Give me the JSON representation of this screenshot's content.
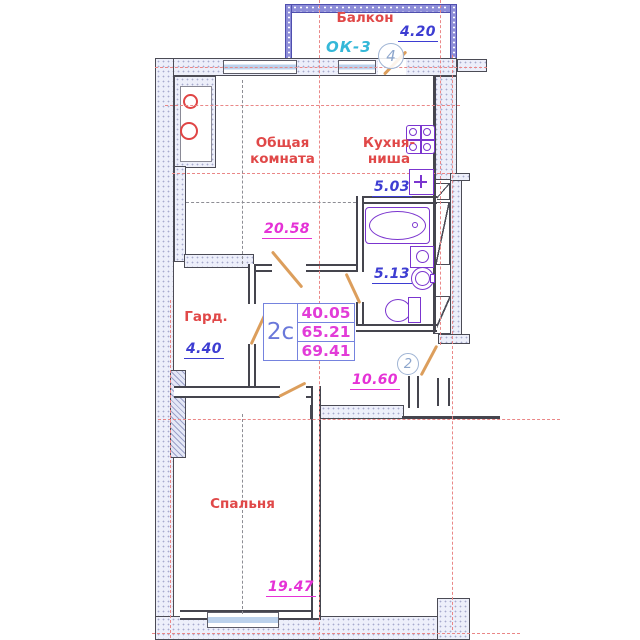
{
  "plan_type": "apartment-floor-plan",
  "rooms": {
    "balcony": {
      "name": "Балкон",
      "window_code": "ОК-3",
      "area": "4.20"
    },
    "common": {
      "name_line1": "Общая",
      "name_line2": "комната",
      "area": "20.58"
    },
    "kitchen": {
      "name_line1": "Кухня-",
      "name_line2": "ниша",
      "area": "5.03"
    },
    "bathroom": {
      "area": "5.13"
    },
    "wardrobe": {
      "name": "Гард.",
      "area": "4.40"
    },
    "hall": {
      "area": "10.60"
    },
    "bedroom": {
      "name": "Спальня",
      "area": "19.47"
    }
  },
  "summary": {
    "code": "2с",
    "rows": [
      "40.05",
      "65.21",
      "69.41"
    ]
  },
  "markers": {
    "balcony_axis": "4",
    "entrance": "2"
  },
  "colors": {
    "room_label_red": "#e04848",
    "area_blue": "#3d3dd2",
    "area_magenta": "#e532d6",
    "window_code_cyan": "#35b8d8",
    "summary_border_blue": "#7583de",
    "door_orange": "#dc9e5c",
    "fixture_purple": "#7b35cf",
    "axis_red": "#ea8787",
    "wall_dark": "#4b4b55",
    "wall_hatch_fill": "#edeffa",
    "balcony_glazing_blue": "#8d8dd8",
    "window_glass_blue": "#bcd2ec"
  }
}
